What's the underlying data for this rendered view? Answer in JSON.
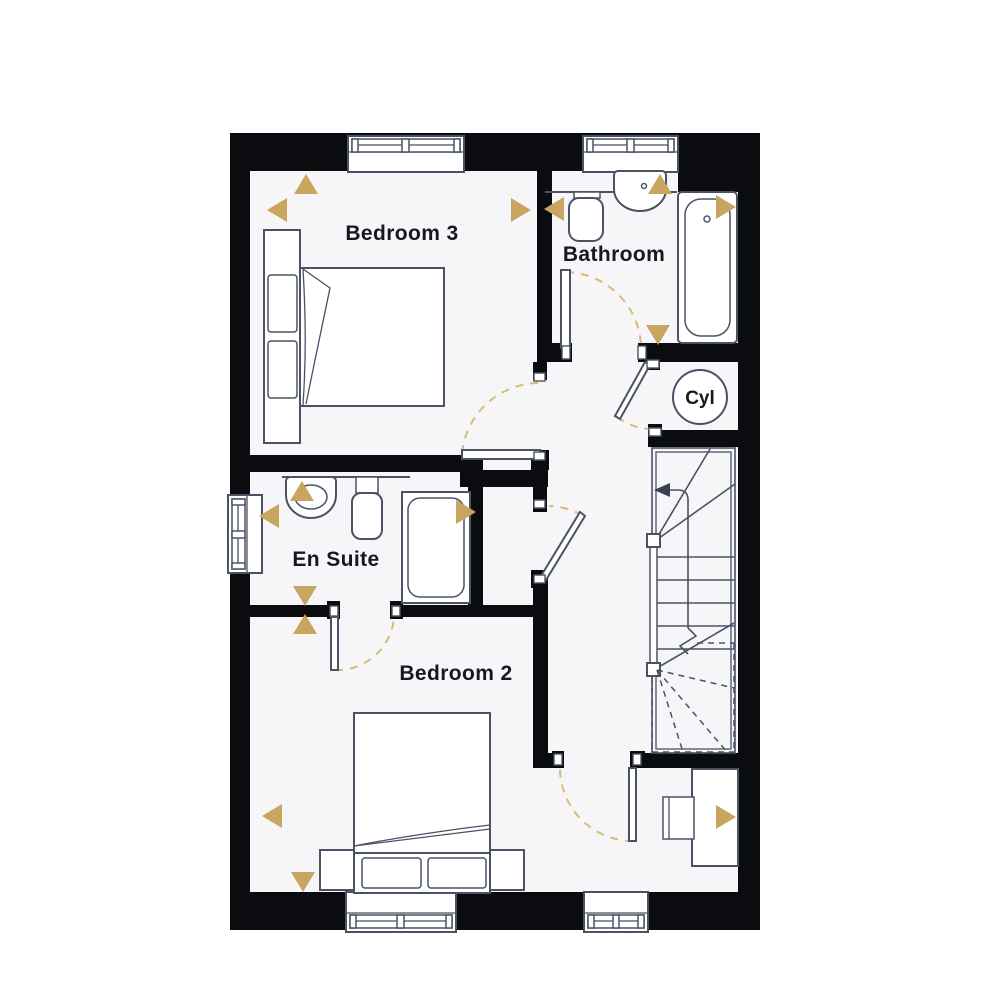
{
  "palette": {
    "wall": "#0b0c10",
    "floor": "#f6f6f8",
    "line": "#4a5264",
    "accent_gold": "#c9a55f",
    "arc_gold": "#d9ba7a",
    "text": "#141821"
  },
  "labels": {
    "bedroom3": "Bedroom 3",
    "bathroom": "Bathroom",
    "ensuite": "En Suite",
    "bedroom2": "Bedroom 2",
    "cylinder": "Cyl"
  },
  "markers": [
    {
      "dir": "up",
      "x": 306,
      "y": 184
    },
    {
      "dir": "left",
      "x": 277,
      "y": 210
    },
    {
      "dir": "right",
      "x": 521,
      "y": 210
    },
    {
      "dir": "left",
      "x": 554,
      "y": 209
    },
    {
      "dir": "up",
      "x": 660,
      "y": 184
    },
    {
      "dir": "right",
      "x": 726,
      "y": 207
    },
    {
      "dir": "down",
      "x": 658,
      "y": 335
    },
    {
      "dir": "up",
      "x": 302,
      "y": 491
    },
    {
      "dir": "left",
      "x": 269,
      "y": 516
    },
    {
      "dir": "right",
      "x": 466,
      "y": 512
    },
    {
      "dir": "down",
      "x": 305,
      "y": 596
    },
    {
      "dir": "up",
      "x": 305,
      "y": 624
    },
    {
      "dir": "left",
      "x": 272,
      "y": 816
    },
    {
      "dir": "down",
      "x": 303,
      "y": 882
    },
    {
      "dir": "right",
      "x": 726,
      "y": 817
    }
  ]
}
